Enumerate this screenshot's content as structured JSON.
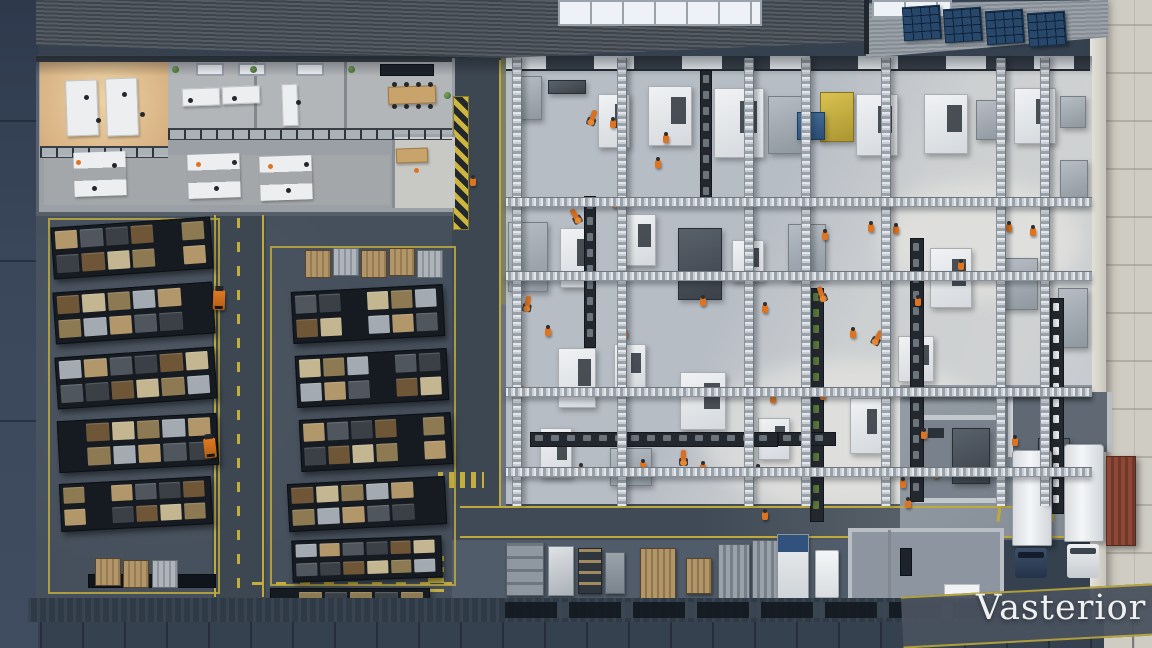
{
  "watermark": {
    "text": "Vasterior"
  },
  "palette": {
    "marking_yellow": "#c2ad3d",
    "robot_orange": "#d96f1f",
    "hivis_orange": "#df7420",
    "production_floor": "#b7bdc5",
    "warehouse_floor": "#46505c",
    "office_warm_floor": "#d9b288",
    "roof_dark": "#474e56",
    "roof_light": "#8d949c",
    "solar_panel_blue": "#27486b",
    "container_red": "#8a4332",
    "truck_trailer_white": "#e9ebed",
    "truck_cab_blue": "#2e3e55",
    "exterior_pavement_right": "#cfccc3",
    "exterior_pavement_left": "#35414f"
  },
  "scene": {
    "solar_panels": [
      [
        903,
        6
      ],
      [
        944,
        8
      ],
      [
        986,
        10
      ],
      [
        1028,
        12
      ]
    ],
    "trusses": {
      "columns": [
        512,
        617,
        744,
        801,
        881,
        996,
        1040
      ],
      "beams": [
        197,
        271,
        387,
        467
      ]
    },
    "machines": [
      [
        514,
        76,
        26,
        42,
        "gray"
      ],
      [
        548,
        80,
        36,
        12,
        "dark"
      ],
      [
        598,
        94,
        30,
        52,
        "white"
      ],
      [
        648,
        86,
        42,
        58,
        "white"
      ],
      [
        714,
        88,
        48,
        68,
        "white"
      ],
      [
        768,
        96,
        34,
        56,
        "gray"
      ],
      [
        820,
        92,
        32,
        48,
        "yellow"
      ],
      [
        856,
        94,
        40,
        60,
        "white"
      ],
      [
        924,
        94,
        42,
        58,
        "white"
      ],
      [
        976,
        100,
        28,
        38,
        "gray"
      ],
      [
        1014,
        88,
        40,
        54,
        "white"
      ],
      [
        1060,
        96,
        24,
        30,
        "gray"
      ],
      [
        797,
        112,
        26,
        26,
        "blue"
      ],
      [
        508,
        222,
        38,
        68,
        "gray"
      ],
      [
        560,
        228,
        30,
        58,
        "white"
      ],
      [
        618,
        214,
        36,
        50,
        "white"
      ],
      [
        678,
        228,
        42,
        70,
        "dark"
      ],
      [
        732,
        240,
        30,
        40,
        "white"
      ],
      [
        788,
        224,
        36,
        54,
        "gray"
      ],
      [
        930,
        248,
        40,
        58,
        "white"
      ],
      [
        1000,
        258,
        36,
        50,
        "gray"
      ],
      [
        1058,
        288,
        28,
        58,
        "gray"
      ],
      [
        558,
        348,
        36,
        58,
        "white"
      ],
      [
        614,
        344,
        30,
        44,
        "white"
      ],
      [
        680,
        372,
        44,
        56,
        "white"
      ],
      [
        540,
        428,
        30,
        48,
        "white"
      ],
      [
        610,
        448,
        40,
        36,
        "gray"
      ],
      [
        758,
        418,
        30,
        40,
        "white"
      ],
      [
        850,
        398,
        30,
        54,
        "white"
      ],
      [
        952,
        428,
        36,
        54,
        "dark"
      ],
      [
        1038,
        438,
        30,
        58,
        "dark"
      ],
      [
        1060,
        160,
        26,
        40,
        "gray"
      ],
      [
        898,
        336,
        34,
        44,
        "white"
      ]
    ],
    "conveyors": [
      [
        530,
        432,
        246,
        13,
        "g"
      ],
      [
        584,
        196,
        10,
        150,
        "g"
      ],
      [
        700,
        70,
        10,
        128,
        "g"
      ],
      [
        810,
        288,
        12,
        232,
        "grn"
      ],
      [
        910,
        238,
        12,
        262,
        "g"
      ],
      [
        1050,
        298,
        12,
        214,
        "w"
      ],
      [
        778,
        432,
        56,
        12,
        "g"
      ]
    ],
    "robots": [
      [
        585,
        110,
        20
      ],
      [
        568,
        208,
        -30
      ],
      [
        520,
        296,
        10
      ],
      [
        510,
        384,
        40
      ],
      [
        814,
        286,
        -20
      ],
      [
        676,
        450,
        0
      ],
      [
        870,
        330,
        30
      ]
    ],
    "workers": [
      [
        470,
        178
      ],
      [
        612,
        200
      ],
      [
        655,
        160
      ],
      [
        545,
        328
      ],
      [
        622,
        330
      ],
      [
        700,
        298
      ],
      [
        748,
        232
      ],
      [
        762,
        305
      ],
      [
        822,
        232
      ],
      [
        850,
        330
      ],
      [
        868,
        224
      ],
      [
        893,
        226
      ],
      [
        915,
        298
      ],
      [
        958,
        262
      ],
      [
        1006,
        224
      ],
      [
        1030,
        228
      ],
      [
        578,
        466
      ],
      [
        640,
        462
      ],
      [
        700,
        464
      ],
      [
        755,
        467
      ],
      [
        820,
        392
      ],
      [
        900,
        480
      ],
      [
        921,
        431
      ],
      [
        933,
        470
      ],
      [
        1012,
        438
      ],
      [
        762,
        512
      ],
      [
        905,
        500
      ],
      [
        610,
        120
      ],
      [
        663,
        135
      ],
      [
        770,
        395
      ]
    ],
    "office": {
      "desks": [
        [
          66,
          80,
          30,
          54,
          "s"
        ],
        [
          106,
          78,
          30,
          56,
          "s"
        ],
        [
          182,
          88,
          36,
          16,
          "s"
        ],
        [
          222,
          86,
          36,
          16,
          "s"
        ],
        [
          282,
          84,
          14,
          40,
          "s"
        ],
        [
          388,
          86,
          46,
          16,
          "w"
        ],
        [
          74,
          152,
          52,
          44,
          "c"
        ],
        [
          188,
          154,
          52,
          44,
          "c"
        ],
        [
          260,
          156,
          52,
          44,
          "c"
        ],
        [
          396,
          148,
          30,
          13,
          "w"
        ]
      ],
      "people": [
        [
          84,
          95,
          "d"
        ],
        [
          96,
          118,
          "d"
        ],
        [
          122,
          92,
          "d"
        ],
        [
          140,
          112,
          "d"
        ],
        [
          76,
          160,
          "o"
        ],
        [
          92,
          186,
          "d"
        ],
        [
          112,
          163,
          "d"
        ],
        [
          196,
          162,
          "o"
        ],
        [
          214,
          186,
          "d"
        ],
        [
          232,
          160,
          "d"
        ],
        [
          268,
          164,
          "o"
        ],
        [
          286,
          188,
          "d"
        ],
        [
          304,
          162,
          "d"
        ],
        [
          188,
          98,
          "d"
        ],
        [
          232,
          96,
          "d"
        ],
        [
          296,
          100,
          "d"
        ],
        [
          414,
          168,
          "o"
        ],
        [
          392,
          82,
          "d"
        ],
        [
          404,
          82,
          "d"
        ],
        [
          416,
          82,
          "d"
        ],
        [
          428,
          82,
          "d"
        ],
        [
          392,
          104,
          "d"
        ],
        [
          404,
          104,
          "d"
        ],
        [
          416,
          104,
          "d"
        ],
        [
          428,
          104,
          "d"
        ]
      ],
      "plants": [
        [
          172,
          66
        ],
        [
          250,
          66
        ],
        [
          348,
          66
        ],
        [
          444,
          92
        ]
      ],
      "skylights": [
        [
          196,
          63
        ],
        [
          238,
          63
        ],
        [
          296,
          63
        ]
      ]
    },
    "warehouse": {
      "racks": [
        [
          52,
          222,
          158,
          50,
          -4,
          "mix"
        ],
        [
          54,
          287,
          158,
          50,
          -4,
          "mix"
        ],
        [
          56,
          352,
          158,
          50,
          -4,
          "mix"
        ],
        [
          58,
          417,
          158,
          50,
          -3,
          "mix"
        ],
        [
          60,
          480,
          150,
          46,
          -3,
          "mix"
        ],
        [
          292,
          288,
          150,
          50,
          -3,
          "mix"
        ],
        [
          296,
          352,
          150,
          50,
          -3,
          "mix"
        ],
        [
          300,
          416,
          150,
          50,
          -3,
          "mix"
        ],
        [
          288,
          480,
          156,
          46,
          -3,
          "mix"
        ],
        [
          292,
          538,
          148,
          40,
          -2,
          "mix"
        ],
        [
          270,
          588,
          158,
          18,
          0,
          "dark"
        ]
      ],
      "pallets": [
        [
          305,
          250,
          "t"
        ],
        [
          333,
          248,
          "s"
        ],
        [
          361,
          250,
          "t"
        ],
        [
          389,
          248,
          "t"
        ],
        [
          417,
          250,
          "s"
        ],
        [
          95,
          558,
          "t"
        ],
        [
          123,
          560,
          "t"
        ],
        [
          152,
          560,
          "s"
        ],
        [
          365,
          590,
          "t"
        ]
      ],
      "forklifts": [
        [
          213,
          290,
          2
        ],
        [
          204,
          438,
          -6
        ]
      ]
    },
    "shipping_items": [
      [
        506,
        542,
        36,
        52,
        "cab"
      ],
      [
        548,
        546,
        24,
        48,
        "mach"
      ],
      [
        578,
        548,
        22,
        44,
        "shelf"
      ],
      [
        605,
        552,
        18,
        40,
        "cart"
      ],
      [
        640,
        548,
        34,
        50,
        "palL"
      ],
      [
        686,
        558,
        24,
        34,
        "palS"
      ],
      [
        718,
        544,
        30,
        54,
        "cont"
      ],
      [
        752,
        540,
        36,
        58,
        "cont"
      ],
      [
        777,
        534,
        30,
        64,
        "truckB"
      ],
      [
        815,
        550,
        22,
        46,
        "white"
      ]
    ],
    "dock": {
      "trucks": [
        {
          "trailer": [
            1012,
            450,
            38,
            94
          ],
          "cab": [
            1015,
            548,
            32,
            30
          ],
          "cab_color": "blue"
        },
        {
          "trailer": [
            1064,
            444,
            38,
            96
          ],
          "cab": [
            1067,
            544,
            32,
            34
          ],
          "cab_color": "white"
        }
      ],
      "container": [
        1106,
        456,
        28,
        88
      ]
    }
  }
}
